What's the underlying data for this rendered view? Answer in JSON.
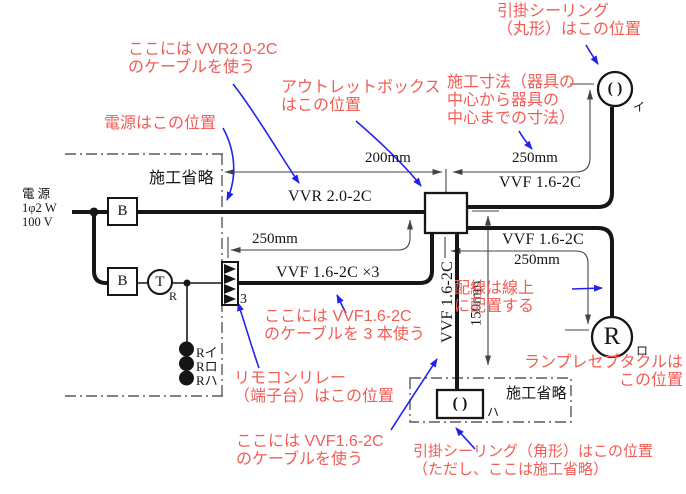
{
  "colors": {
    "background": "#ffffff",
    "ink": "#161616",
    "annotation": "#f25c55",
    "arrow": "#2222ee",
    "dim": "#444444",
    "dash": "#5a5a5a"
  },
  "labels": {
    "power": "電 源\n1φ2 W\n100 V",
    "omission_left": "施工省略",
    "omission_bottom": "施工省略",
    "cable_vvr": "VVR 2.0-2C",
    "cable_vvf_top": "VVF 1.6-2C",
    "cable_vvf_mid": "VVF 1.6-2C",
    "cable_vvf_x3": "VVF 1.6-2C ×3",
    "cable_vvf_drop": "VVF 1.6-2C",
    "dim_200": "200mm",
    "dim_250_top": "250mm",
    "dim_250_left": "250mm",
    "dim_250_right": "250mm",
    "dim_150": "150mm"
  },
  "symbols": {
    "breaker_1": "B",
    "breaker_2": "B",
    "transformer": "T",
    "transformer_sub": "R",
    "relay_count": "3",
    "switch_1": "Rイ",
    "switch_2": "Rロ",
    "switch_3": "Rハ",
    "rose_round_glyph": "( )",
    "rose_square_glyph": "( )",
    "receptacle_letter": "R",
    "fixture_i": "イ",
    "fixture_ro": "ロ",
    "fixture_ha": "ハ"
  },
  "annotations": {
    "vvr_cable": "ここには VVR2.0-2C\nのケーブルを使う",
    "power_pos": "電源はこの位置",
    "outlet_box": "アウトレットボックス\nはこの位置",
    "dim_note": "施工寸法（器具の\n中心から器具の\n中心までの寸法）",
    "rose_round": "引掛シーリング\n（丸形）はこの位置",
    "wiring_on_line": "配線は線上\nに配置する",
    "receptacle": "ランプレセプタクルは\nこの位置",
    "relay": "リモコンリレー\n（端子台）はこの位置",
    "vvf_x3_cable": "ここには VVF1.6-2C\nのケーブルを 3 本使う",
    "vvf_cable": "ここには VVF1.6-2C\nのケーブルを使う",
    "rose_square": "引掛シーリング（角形）はこの位置\n（ただし、ここは施工省略）"
  }
}
